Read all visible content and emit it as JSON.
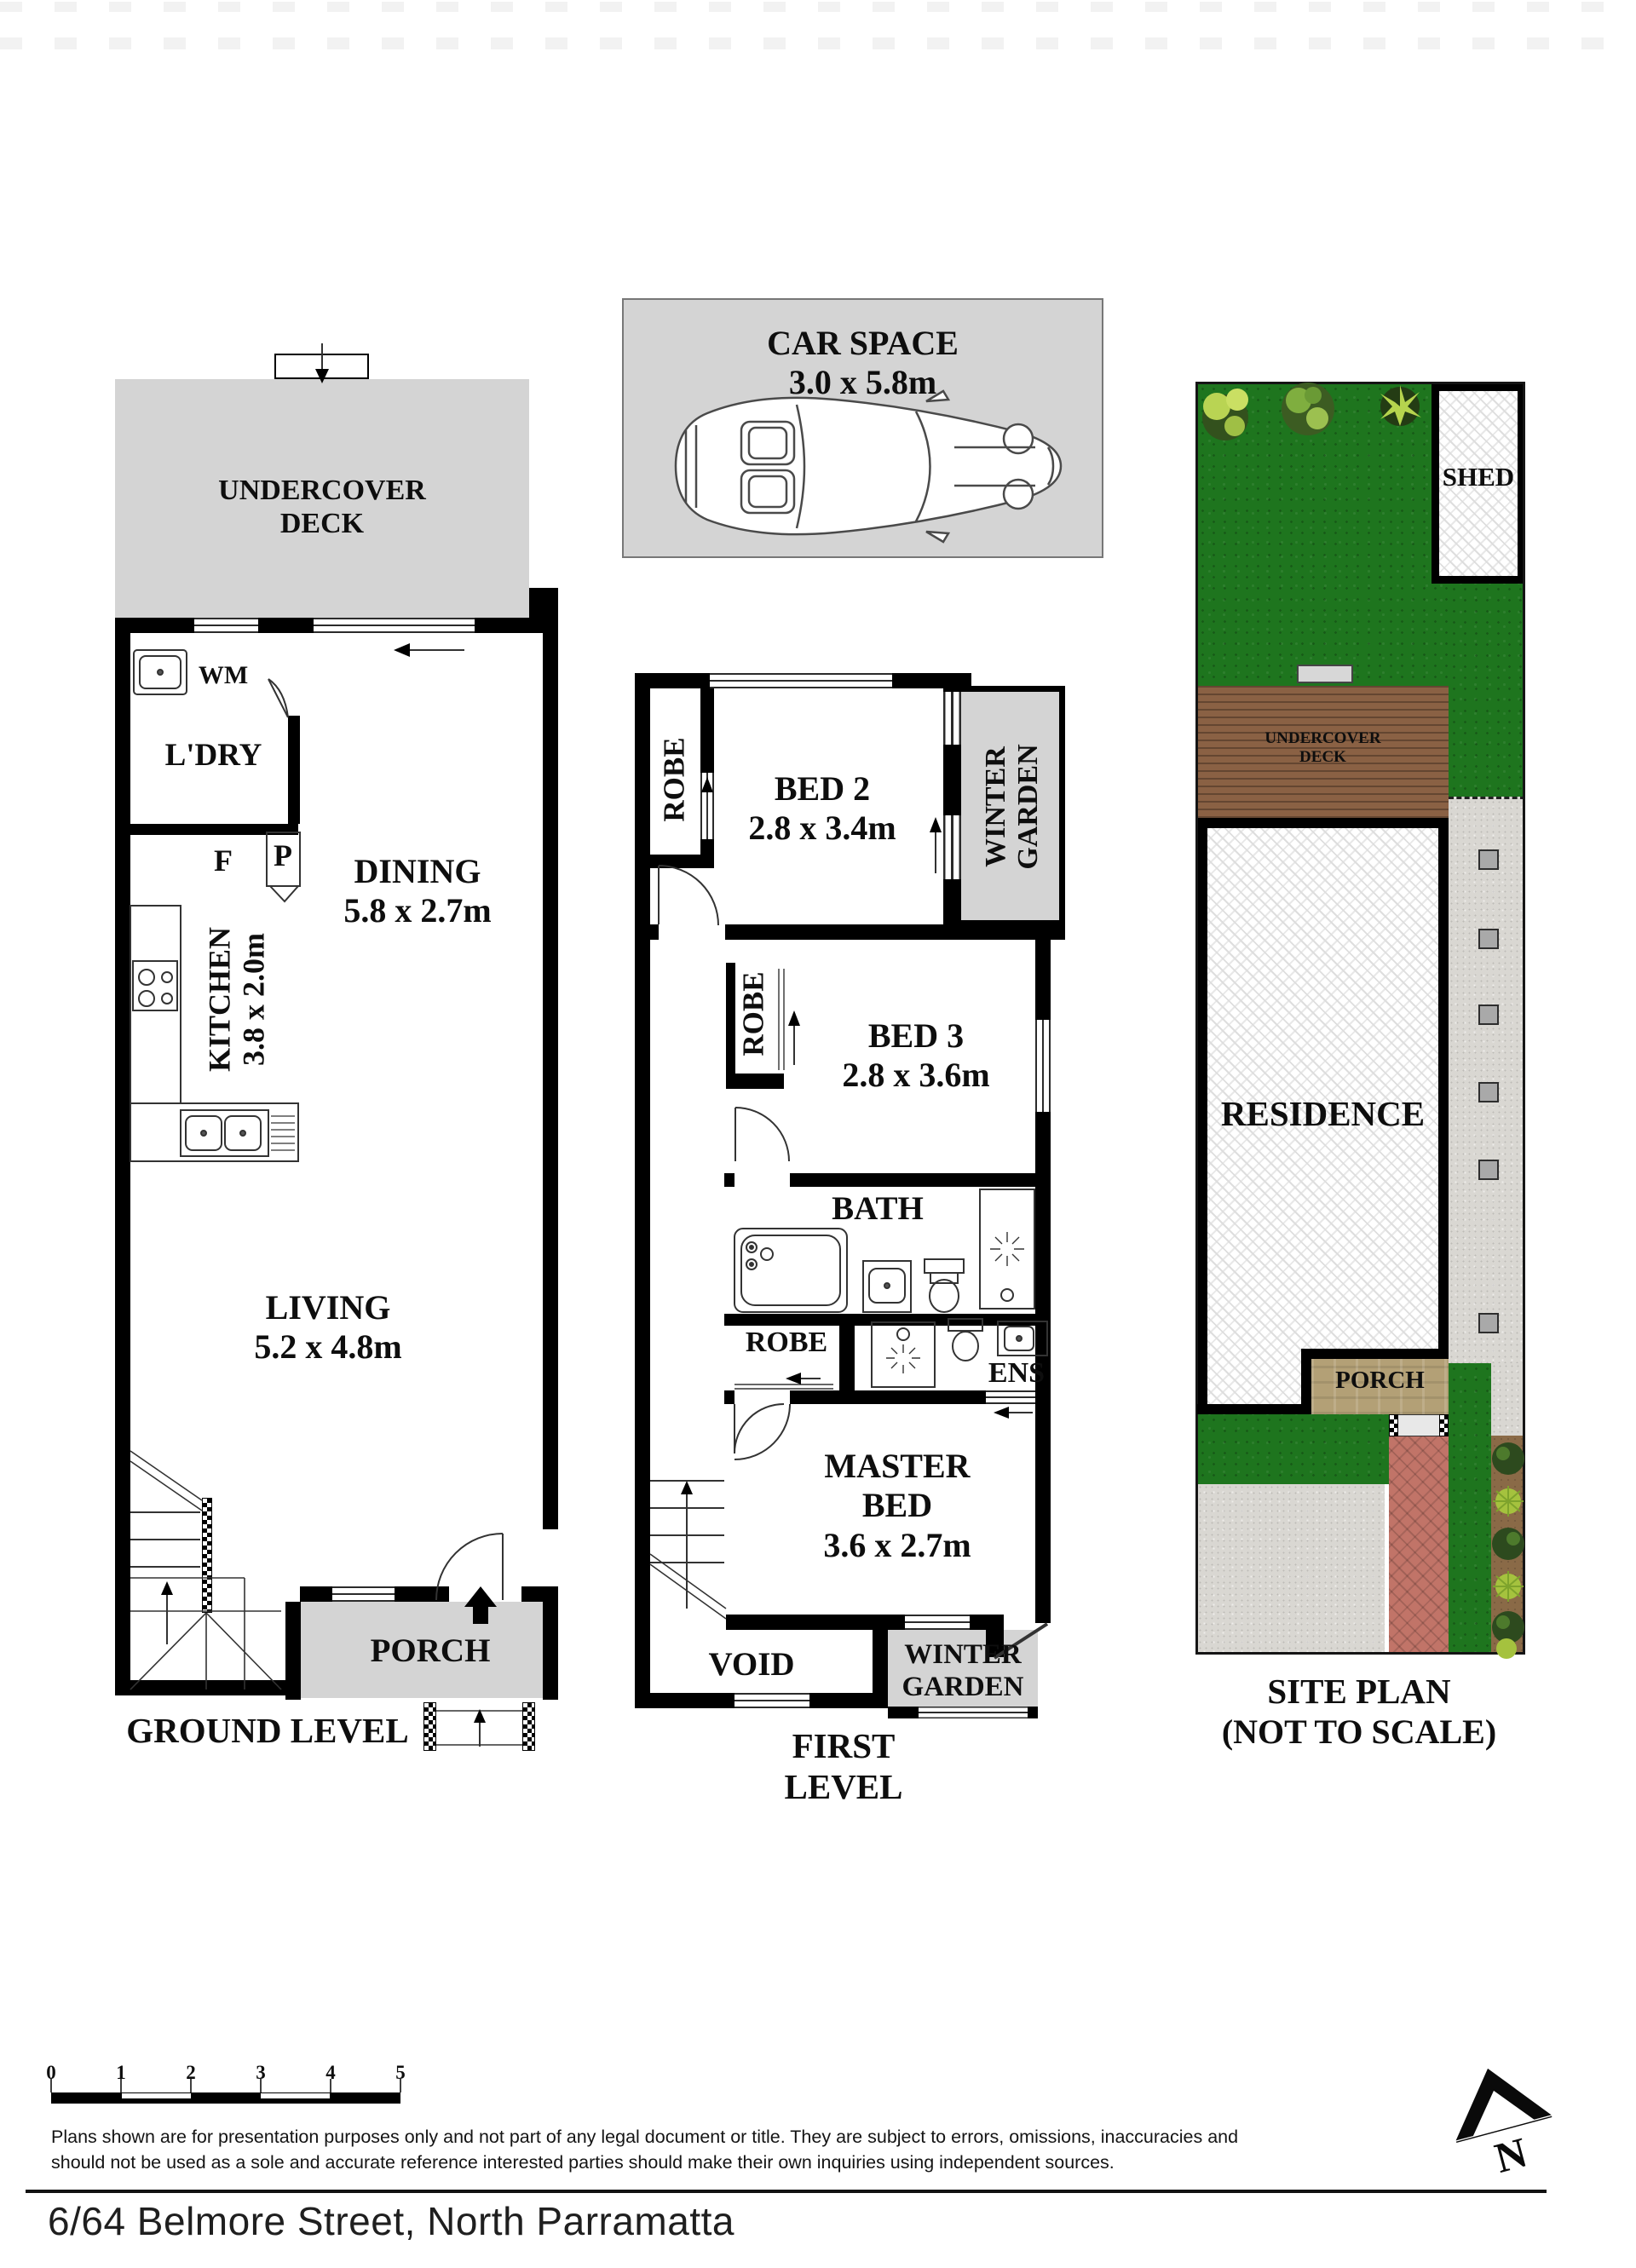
{
  "colors": {
    "zone-gray": "#d4d4d4",
    "grass-green": "#1e751e",
    "deck-brown": "#8a6144",
    "porch-tan": "#b3a076",
    "path-red": "#c17468",
    "concrete-gray": "#d9d7d2",
    "garden-soil": "#8a6a47",
    "paver-gray": "#a9a9a9"
  },
  "car_space": {
    "title": "CAR SPACE",
    "dims": "3.0 x 5.8m"
  },
  "ground_level": {
    "title": "GROUND LEVEL",
    "deck_label": "UNDERCOVER DECK",
    "wm_label": "WM",
    "laundry_label": "L'DRY",
    "fridge_label": "F",
    "pantry_label": "P",
    "kitchen_name": "KITCHEN",
    "kitchen_dims": "3.8 x 2.0m",
    "dining_name": "DINING",
    "dining_dims": "5.8 x 2.7m",
    "living_name": "LIVING",
    "living_dims": "5.2 x 4.8m",
    "porch_label": "PORCH"
  },
  "first_level": {
    "title": "FIRST LEVEL",
    "robe1_label": "ROBE",
    "bed2_name": "BED 2",
    "bed2_dims": "2.8 x 3.4m",
    "winter_garden_top_label": "WINTER GARDEN",
    "robe2_label": "ROBE",
    "bed3_name": "BED 3",
    "bed3_dims": "2.8 x 3.6m",
    "bath_label": "BATH",
    "robe3_label": "ROBE",
    "ens_label": "ENS",
    "master_name": "MASTER BED",
    "master_dims": "3.6 x 2.7m",
    "void_label": "VOID",
    "winter_garden_bottom_label": "WINTER GARDEN"
  },
  "site_plan": {
    "title": "SITE PLAN",
    "subtitle": "(NOT TO SCALE)",
    "shed_label": "SHED",
    "deck_label": "UNDERCOVER DECK",
    "residence_label": "RESIDENCE",
    "porch_label": "PORCH"
  },
  "scale_bar": {
    "ticks": [
      "0",
      "1",
      "2",
      "3",
      "4",
      "5"
    ]
  },
  "footer": {
    "disclaimer_line1": "Plans shown are for presentation purposes only and not part of any legal document or title. They are subject to errors, omissions, inaccuracies and",
    "disclaimer_line2": "should not be used as a sole and accurate reference interested parties should make their own inquiries using independent sources.",
    "address": "6/64 Belmore Street, North Parramatta"
  },
  "compass": {
    "north_label": "N"
  }
}
